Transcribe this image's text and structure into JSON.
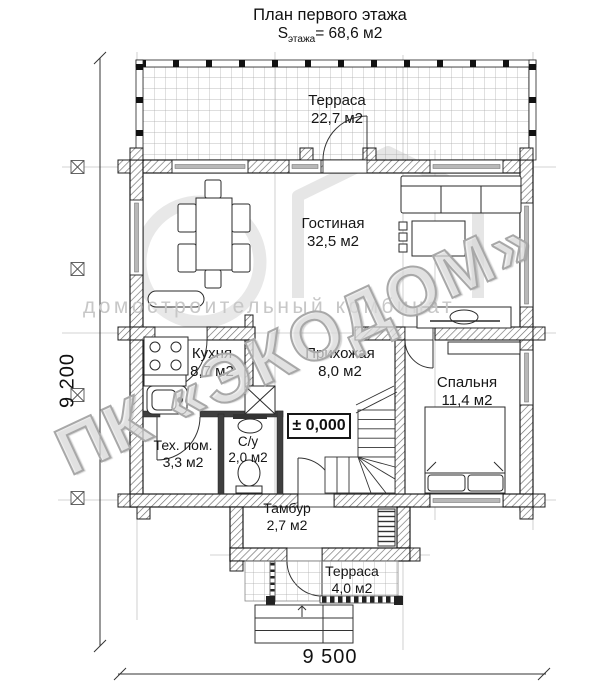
{
  "title": "План первого этажа",
  "subtitle": {
    "prefix": "S",
    "sub": "этажа",
    "rest": "= 68,6 м2"
  },
  "rooms": {
    "terrace_top": {
      "name": "Терраса",
      "area": "22,7 м2"
    },
    "living": {
      "name": "Гостиная",
      "area": "32,5 м2"
    },
    "kitchen": {
      "name": "Кухня",
      "area": "8,7 м2"
    },
    "hallway": {
      "name": "Прихожая",
      "area": "8,0 м2"
    },
    "bedroom": {
      "name": "Спальня",
      "area": "11,4 м2"
    },
    "tech": {
      "name": "Тех. пом.",
      "area": "3,3 м2"
    },
    "bath": {
      "name": "С/у",
      "area": "2,0 м2"
    },
    "tambour": {
      "name": "Тамбур",
      "area": "2,7 м2"
    },
    "terrace_bottom": {
      "name": "Терраса",
      "area": "4,0 м2"
    }
  },
  "elevation_mark": "± 0,000",
  "dimensions": {
    "left": "9 200",
    "bottom": "9 500"
  },
  "watermark": {
    "company": "ПК «ЭКОДОМ»",
    "tagline": "домостроительный комбинат"
  },
  "colors": {
    "line": "#1c1c1c",
    "wall_hatch": "#6e6e6e",
    "dark_wall": "#3f3f3f",
    "window_glass": "#b8b8b8",
    "grid": "#a8a8a8",
    "watermark_gray": "#c7c7c7",
    "watermark_outline": "#a8a8a8"
  }
}
